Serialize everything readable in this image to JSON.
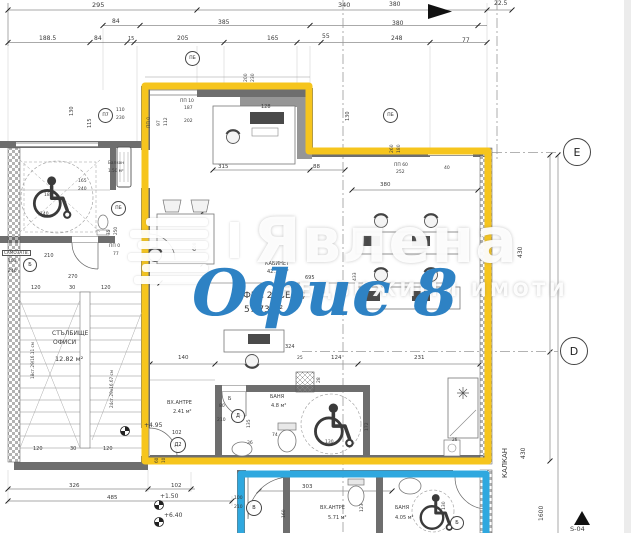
{
  "watermark": {
    "brand": "Явлена",
    "tagline": "НЕДВИЖИМИ ИМОТИ",
    "logo_icon": "stripes-logo"
  },
  "overlay": {
    "title": "Офис 8",
    "color": "#2e82c4"
  },
  "colors": {
    "unit_outline": "#f6c51d",
    "lower_unit_outline": "#2fa8df",
    "walls": "#6e6e6e"
  },
  "rooms": [
    {
      "name": "КАБИНЕТ",
      "area": "42.13 м²"
    },
    {
      "name": "ОФИС 2 (ВЕ1а)",
      "area": "57.73 м²"
    },
    {
      "name": "СТЪЛБИЩЕ ОФИСИ",
      "area": "12.82 м²"
    },
    {
      "name": "ВХ.АНТРЕ",
      "area": "2.41 м²"
    },
    {
      "name": "БАНЯ",
      "area": "4.8 м²"
    },
    {
      "name": "ВХ.АНТРЕ",
      "area": "5.71 м²"
    },
    {
      "name": "БАНЯ",
      "area": "4.05 м²"
    },
    {
      "name": "Балкон",
      "area": "1.50 м²"
    }
  ],
  "levels": [
    "+4.95",
    "+1.50",
    "+6.40"
  ],
  "labels": [
    {
      "t": "295",
      "x": 92,
      "y": 2,
      "s": 6.5
    },
    {
      "t": "340",
      "x": 338,
      "y": 2,
      "s": 6.5
    },
    {
      "t": "380",
      "x": 389,
      "y": 2,
      "s": 6
    },
    {
      "t": "22.5",
      "x": 494,
      "y": 1,
      "s": 6
    },
    {
      "t": "84",
      "x": 112,
      "y": 19,
      "s": 6
    },
    {
      "t": "385",
      "x": 218,
      "y": 20,
      "s": 6
    },
    {
      "t": "380",
      "x": 392,
      "y": 21,
      "s": 6
    },
    {
      "t": "188.5",
      "x": 39,
      "y": 36,
      "s": 6
    },
    {
      "t": "84",
      "x": 94,
      "y": 36,
      "s": 6
    },
    {
      "t": "15",
      "x": 128,
      "y": 37,
      "s": 5
    },
    {
      "t": "205",
      "x": 177,
      "y": 36,
      "s": 6
    },
    {
      "t": "165",
      "x": 267,
      "y": 36,
      "s": 6
    },
    {
      "t": "55",
      "x": 322,
      "y": 34,
      "s": 6
    },
    {
      "t": "248",
      "x": 391,
      "y": 36,
      "s": 6
    },
    {
      "t": "77",
      "x": 462,
      "y": 38,
      "s": 6
    },
    {
      "t": "ПП 10",
      "x": 180,
      "y": 100,
      "s": 4.5
    },
    {
      "t": "187",
      "x": 184,
      "y": 107,
      "s": 4.5
    },
    {
      "t": "202",
      "x": 184,
      "y": 120,
      "s": 4.5
    },
    {
      "t": "128",
      "x": 261,
      "y": 105,
      "s": 5
    },
    {
      "t": "110",
      "x": 116,
      "y": 109,
      "s": 4.5
    },
    {
      "t": "230",
      "x": 116,
      "y": 117,
      "s": 4.5
    },
    {
      "t": "200",
      "x": 245,
      "y": 82,
      "r": -90,
      "s": 4.5
    },
    {
      "t": "230",
      "x": 252,
      "y": 82,
      "r": -90,
      "s": 4.5
    },
    {
      "t": "130",
      "x": 70,
      "y": 116,
      "r": -90,
      "s": 5
    },
    {
      "t": "115",
      "x": 88,
      "y": 128,
      "r": -90,
      "s": 5
    },
    {
      "t": "ПП 0",
      "x": 148,
      "y": 128,
      "r": -90,
      "s": 4.5
    },
    {
      "t": "97",
      "x": 158,
      "y": 126,
      "r": -90,
      "s": 4.5
    },
    {
      "t": "112",
      "x": 165,
      "y": 126,
      "r": -90,
      "s": 4.5
    },
    {
      "t": "130",
      "x": 346,
      "y": 121,
      "r": -90,
      "s": 5
    },
    {
      "t": "260",
      "x": 391,
      "y": 153,
      "r": -90,
      "s": 4.5
    },
    {
      "t": "180",
      "x": 398,
      "y": 153,
      "r": -90,
      "s": 4.5
    },
    {
      "t": "315",
      "x": 218,
      "y": 165,
      "s": 5.5
    },
    {
      "t": "88",
      "x": 313,
      "y": 165,
      "s": 5.5
    },
    {
      "t": "ПП 60",
      "x": 394,
      "y": 164,
      "s": 4.5
    },
    {
      "t": "252",
      "x": 396,
      "y": 171,
      "s": 4.5
    },
    {
      "t": "40",
      "x": 444,
      "y": 167,
      "s": 4.5
    },
    {
      "t": "380",
      "x": 380,
      "y": 183,
      "s": 5.5
    },
    {
      "t": "695",
      "x": 305,
      "y": 276,
      "s": 5
    },
    {
      "t": "608",
      "x": 194,
      "y": 251,
      "r": -90,
      "s": 4.5
    },
    {
      "t": "433",
      "x": 354,
      "y": 281,
      "r": -90,
      "s": 4.5
    },
    {
      "t": "КАБИНЕТ",
      "x": 265,
      "y": 262,
      "s": 5
    },
    {
      "t": "42.13 м²",
      "x": 267,
      "y": 270,
      "s": 5
    },
    {
      "t": "ОФИС 2 (ВЕ1а)",
      "x": 236,
      "y": 292,
      "s": 9
    },
    {
      "t": "57.73 м²",
      "x": 244,
      "y": 306,
      "s": 9
    },
    {
      "t": "140",
      "x": 178,
      "y": 356,
      "s": 5.5
    },
    {
      "t": "324",
      "x": 285,
      "y": 345,
      "s": 5
    },
    {
      "t": "25",
      "x": 297,
      "y": 357,
      "s": 4.5
    },
    {
      "t": "124",
      "x": 331,
      "y": 356,
      "s": 5.5
    },
    {
      "t": "231",
      "x": 414,
      "y": 356,
      "s": 5.5
    },
    {
      "t": "28",
      "x": 318,
      "y": 383,
      "r": -90,
      "s": 4.5
    },
    {
      "t": "26",
      "x": 452,
      "y": 438,
      "s": 4.2
    },
    {
      "t": "ВХ.АНТРЕ",
      "x": 167,
      "y": 401,
      "s": 5
    },
    {
      "t": "2.41 м²",
      "x": 173,
      "y": 410,
      "s": 5
    },
    {
      "t": "БАНЯ",
      "x": 270,
      "y": 395,
      "s": 5
    },
    {
      "t": "4.8 м²",
      "x": 271,
      "y": 404,
      "s": 5
    },
    {
      "t": "Б",
      "x": 228,
      "y": 397,
      "s": 5
    },
    {
      "t": "80",
      "x": 219,
      "y": 405,
      "s": 4.5
    },
    {
      "t": "210",
      "x": 217,
      "y": 419,
      "s": 4.5
    },
    {
      "t": "135",
      "x": 248,
      "y": 428,
      "r": -90,
      "s": 4.5
    },
    {
      "t": "172",
      "x": 366,
      "y": 431,
      "r": -90,
      "s": 4.5
    },
    {
      "t": "74",
      "x": 272,
      "y": 434,
      "s": 4.5
    },
    {
      "t": "36",
      "x": 247,
      "y": 442,
      "s": 4.5
    },
    {
      "t": "130",
      "x": 325,
      "y": 441,
      "s": 4.5
    },
    {
      "t": "102",
      "x": 172,
      "y": 431,
      "s": 5
    },
    {
      "t": "60",
      "x": 155,
      "y": 463,
      "r": -90,
      "s": 4.2
    },
    {
      "t": "10",
      "x": 162,
      "y": 463,
      "r": -90,
      "s": 4.2
    },
    {
      "t": "Балкон",
      "x": 108,
      "y": 161,
      "s": 4.2
    },
    {
      "t": "1.50 м²",
      "x": 108,
      "y": 169,
      "s": 4.2
    },
    {
      "t": "165",
      "x": 78,
      "y": 180,
      "s": 4.5
    },
    {
      "t": "240",
      "x": 78,
      "y": 188,
      "s": 4.5
    },
    {
      "t": "180",
      "x": 44,
      "y": 194,
      "s": 4.5
    },
    {
      "t": "140",
      "x": 40,
      "y": 213,
      "s": 4.5
    },
    {
      "t": "75",
      "x": 107,
      "y": 235,
      "r": -90,
      "s": 4.2
    },
    {
      "t": "250",
      "x": 114,
      "y": 235,
      "r": -90,
      "s": 4.2
    },
    {
      "t": "ПП 0",
      "x": 109,
      "y": 245,
      "s": 4.5
    },
    {
      "t": "77",
      "x": 113,
      "y": 253,
      "s": 4.5
    },
    {
      "t": "САМОЗАТВ.",
      "x": 2,
      "y": 250,
      "s": 4.2,
      "b": 1
    },
    {
      "t": "103",
      "x": 8,
      "y": 260,
      "s": 4.5
    },
    {
      "t": "240",
      "x": 8,
      "y": 270,
      "s": 4.5
    },
    {
      "t": "210",
      "x": 44,
      "y": 254,
      "s": 5
    },
    {
      "t": "270",
      "x": 68,
      "y": 275,
      "s": 5
    },
    {
      "t": "120",
      "x": 31,
      "y": 286,
      "s": 5
    },
    {
      "t": "30",
      "x": 69,
      "y": 286,
      "s": 5
    },
    {
      "t": "120",
      "x": 101,
      "y": 286,
      "s": 5
    },
    {
      "t": "СТЪЛБИЩЕ",
      "x": 52,
      "y": 331,
      "s": 6
    },
    {
      "t": "ОФИСИ",
      "x": 53,
      "y": 340,
      "s": 6
    },
    {
      "t": "12.82 м²",
      "x": 55,
      "y": 356,
      "s": 6.5
    },
    {
      "t": "18ст.29/16.11 см",
      "x": 31,
      "y": 379,
      "r": -90,
      "s": 4.2
    },
    {
      "t": "24ст.29х16.67 см",
      "x": 110,
      "y": 408,
      "r": -90,
      "s": 4.2
    },
    {
      "t": "+4.95",
      "x": 144,
      "y": 423,
      "s": 6
    },
    {
      "t": "120",
      "x": 33,
      "y": 447,
      "s": 5
    },
    {
      "t": "30",
      "x": 70,
      "y": 447,
      "s": 5
    },
    {
      "t": "120",
      "x": 103,
      "y": 447,
      "s": 5
    },
    {
      "t": "326",
      "x": 69,
      "y": 484,
      "s": 5.5
    },
    {
      "t": "485",
      "x": 107,
      "y": 496,
      "s": 5.5
    },
    {
      "t": "102",
      "x": 171,
      "y": 484,
      "s": 5.5
    },
    {
      "t": "+1.50",
      "x": 160,
      "y": 494,
      "s": 6
    },
    {
      "t": "+6.40",
      "x": 164,
      "y": 513,
      "s": 6
    },
    {
      "t": "303",
      "x": 302,
      "y": 485,
      "s": 5.5
    },
    {
      "t": "100",
      "x": 234,
      "y": 497,
      "s": 4.5
    },
    {
      "t": "210",
      "x": 234,
      "y": 506,
      "s": 4.5
    },
    {
      "t": "123",
      "x": 361,
      "y": 512,
      "r": -90,
      "s": 4.5
    },
    {
      "t": "160",
      "x": 283,
      "y": 518,
      "r": -90,
      "s": 4.5
    },
    {
      "t": "ВХ.АНТРЕ",
      "x": 320,
      "y": 506,
      "s": 5
    },
    {
      "t": "5.71 м²",
      "x": 328,
      "y": 516,
      "s": 5
    },
    {
      "t": "БАНЯ",
      "x": 395,
      "y": 506,
      "s": 5
    },
    {
      "t": "4.05 м²",
      "x": 395,
      "y": 516,
      "s": 5
    },
    {
      "t": "130",
      "x": 443,
      "y": 510,
      "r": -90,
      "s": 4.5
    },
    {
      "t": "430",
      "x": 518,
      "y": 258,
      "r": -90,
      "s": 6
    },
    {
      "t": "430",
      "x": 521,
      "y": 459,
      "r": -90,
      "s": 6
    },
    {
      "t": "КАЛКАН",
      "x": 502,
      "y": 478,
      "r": -90,
      "s": 7
    },
    {
      "t": "1600",
      "x": 539,
      "y": 521,
      "r": -90,
      "s": 6
    },
    {
      "t": "S-04",
      "x": 570,
      "y": 526,
      "s": 6.5
    }
  ],
  "circles": [
    {
      "t": "ПБ",
      "x": 185,
      "y": 51,
      "d": 15,
      "s": 4.5
    },
    {
      "t": "П7",
      "x": 98,
      "y": 108,
      "d": 15,
      "s": 4.5
    },
    {
      "t": "ПБ",
      "x": 383,
      "y": 108,
      "d": 15,
      "s": 4.5
    },
    {
      "t": "ПБ",
      "x": 111,
      "y": 201,
      "d": 15,
      "s": 4.5
    },
    {
      "t": "Б",
      "x": 23,
      "y": 258,
      "d": 14,
      "s": 5
    },
    {
      "t": "Д2",
      "x": 170,
      "y": 437,
      "d": 16,
      "s": 5
    },
    {
      "t": "Д",
      "x": 231,
      "y": 409,
      "d": 14,
      "s": 5
    },
    {
      "t": "В",
      "x": 246,
      "y": 500,
      "d": 16,
      "s": 5
    },
    {
      "t": "Б",
      "x": 450,
      "y": 516,
      "d": 14,
      "s": 5
    },
    {
      "t": "Е",
      "x": 563,
      "y": 138,
      "d": 28,
      "s": 11
    },
    {
      "t": "D",
      "x": 560,
      "y": 337,
      "d": 28,
      "s": 11
    }
  ]
}
